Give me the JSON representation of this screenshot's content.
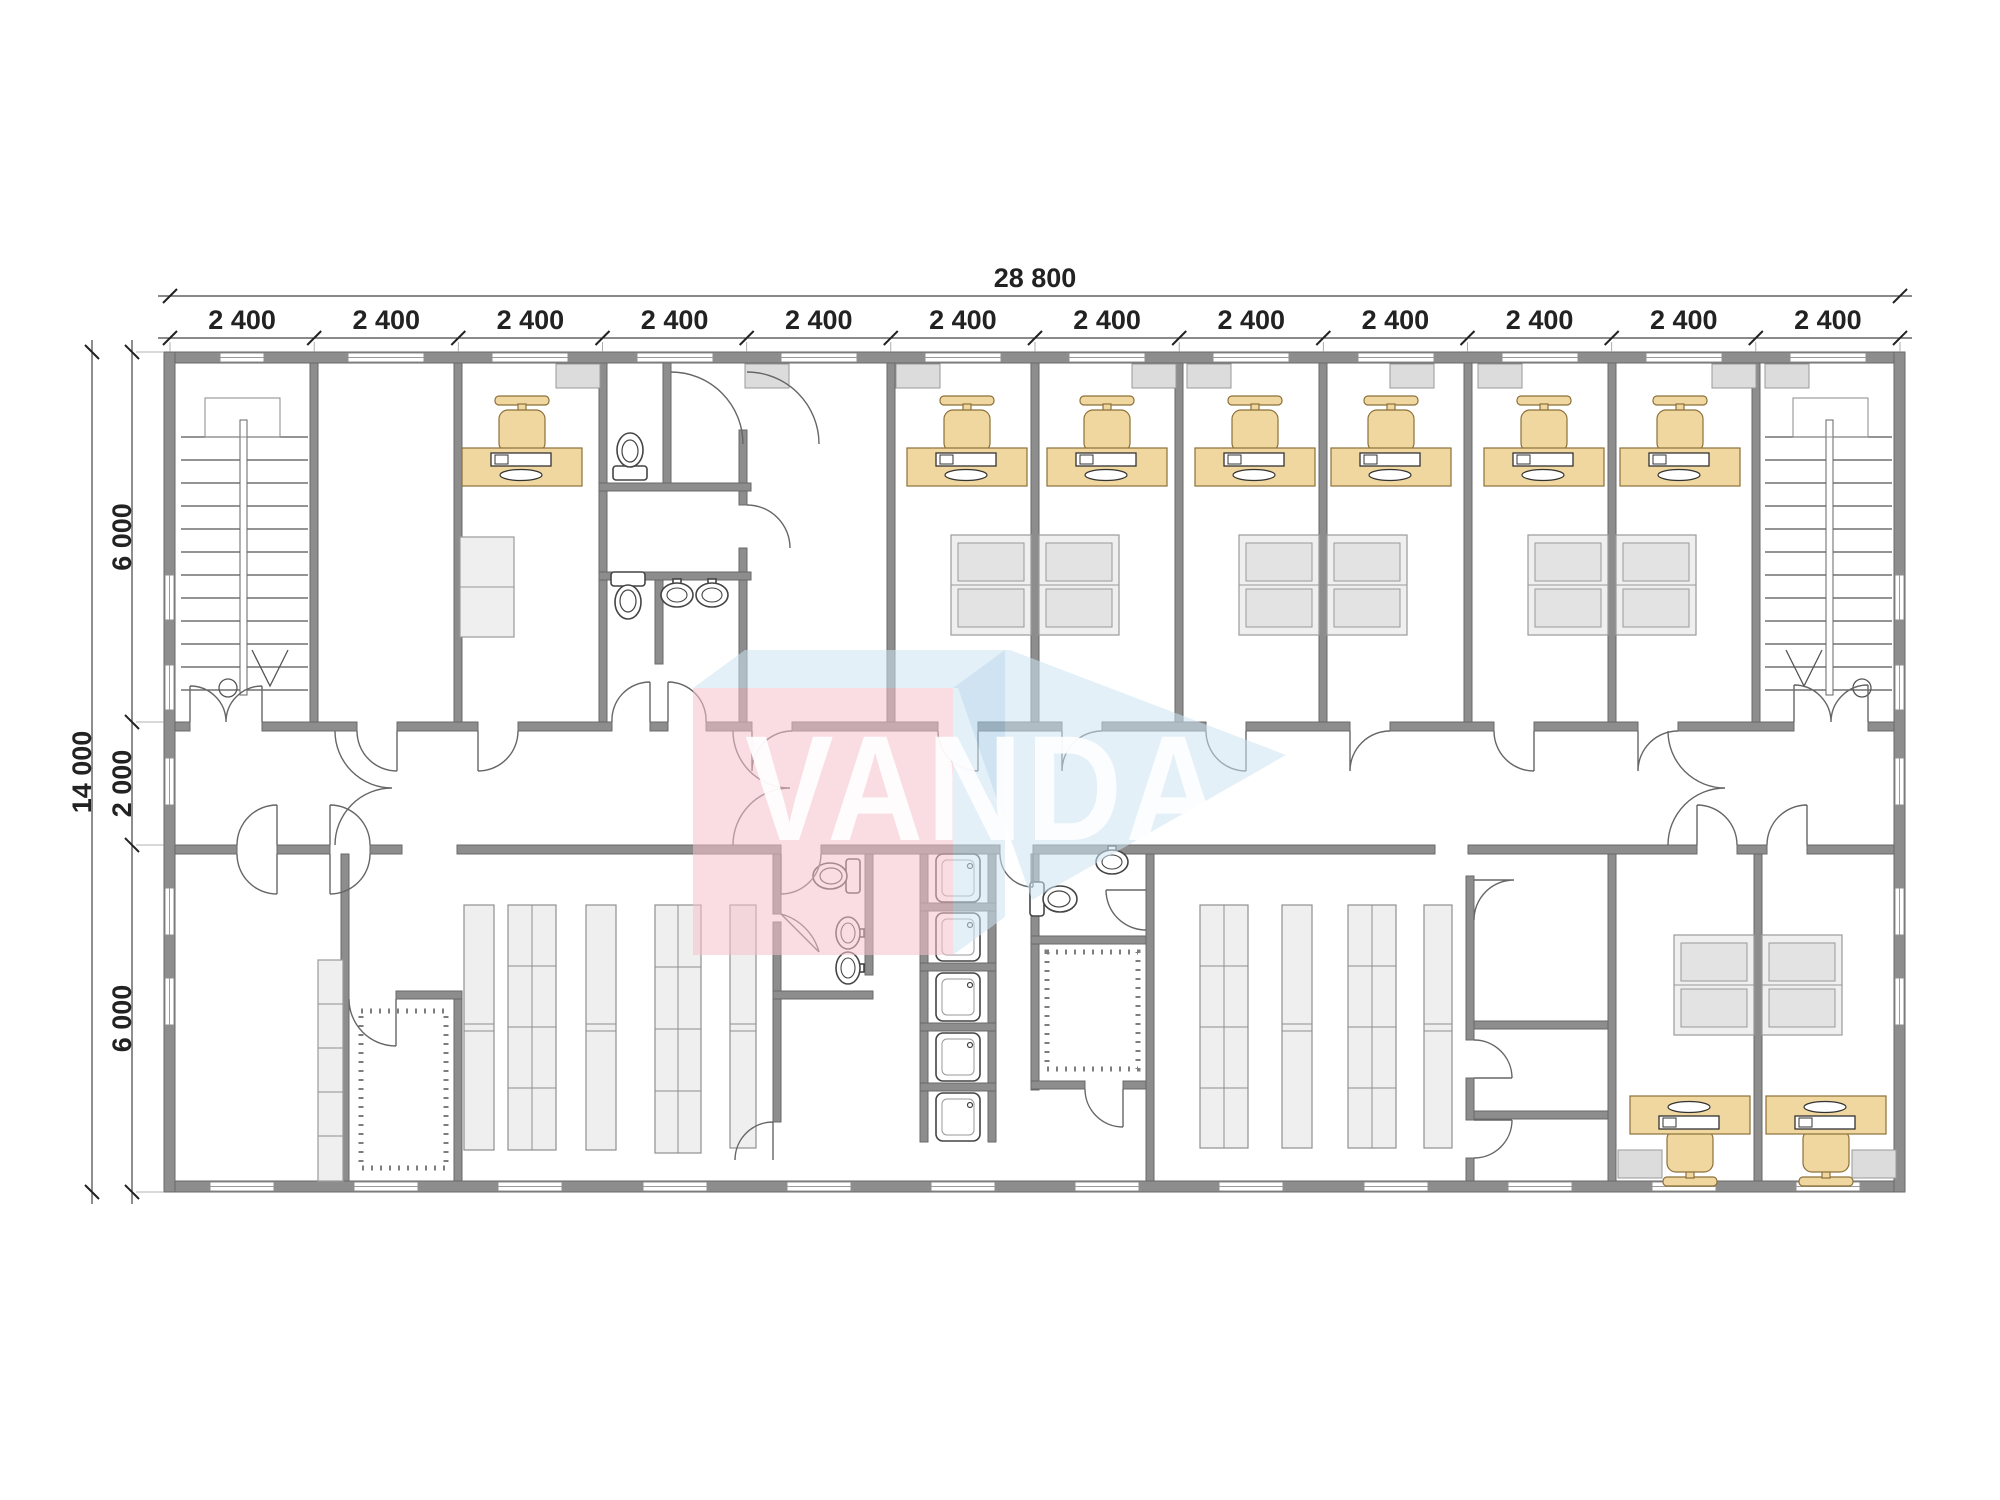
{
  "document": {
    "type": "floor-plan-drawing"
  },
  "watermark": {
    "text": "VANDA"
  },
  "dimensions": {
    "overall_width": {
      "label": "28 800",
      "unit_mm": 28800
    },
    "bays": {
      "labels": [
        "2 400",
        "2 400",
        "2 400",
        "2 400",
        "2 400",
        "2 400",
        "2 400",
        "2 400",
        "2 400",
        "2 400",
        "2 400",
        "2 400"
      ]
    },
    "overall_height": {
      "label": "14 000",
      "unit_mm": 14000
    },
    "rows": {
      "labels": [
        "6 000",
        "2 000",
        "6 000"
      ]
    }
  },
  "colors": {
    "wall": "#8d8d8d",
    "wall_edge": "#696969",
    "line": "#555555",
    "furniture_wood": "#f0d7a0",
    "furniture_wood_edge": "#8c7038",
    "cabinet": "#efefef",
    "cabinet_edge": "#9a9a9a",
    "vent": "#dcdcdc",
    "dim_text": "#222222",
    "watermark_pink": "#f6c2cc",
    "watermark_blue": "#cfe5f4",
    "watermark_text": "#ffffff"
  }
}
